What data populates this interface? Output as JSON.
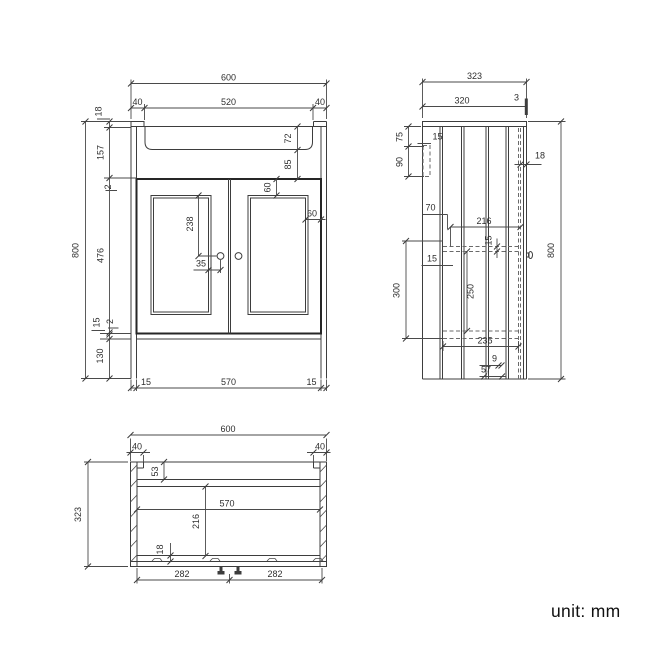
{
  "front": {
    "overall_width": "600",
    "basin_width": "520",
    "basin_offset_left": "40",
    "basin_offset_right": "40",
    "overall_height": "800",
    "top_thickness": "18",
    "upper_section": "157",
    "door_top_gap": "2",
    "door_height": "476",
    "door_bottom_gap": "2",
    "bottom_rail": "15",
    "plinth_height": "130",
    "basin_depth": "72",
    "basin_to_doors": "85",
    "panel_to_knob": "238",
    "knob_offset": "35",
    "panel_top_inset": "60",
    "panel_side_inset": "60",
    "side_thickness_left": "15",
    "interior_width": "570",
    "side_thickness_right": "15"
  },
  "side": {
    "overall_depth": "323",
    "top_depth": "320",
    "back_panel": "3",
    "rail_top_offset": "75",
    "rail_height": "90",
    "rail_thickness": "15",
    "back_gap": "70",
    "door_thickness": "18",
    "shelf_depth": "216",
    "shelf_thickness": "15",
    "shelf_back_gap": "15",
    "opening_height": "300",
    "shelf_to_bottom": "250",
    "bottom_panel_depth": "235",
    "plinth_recess": "9",
    "plinth_depth": "57",
    "overall_height": "800"
  },
  "plan": {
    "overall_width": "600",
    "bracket_left": "40",
    "bracket_right": "40",
    "overall_depth": "323",
    "back_rail_depth": "53",
    "interior_width": "570",
    "interior_depth": "216",
    "door_thickness": "18",
    "door_left_width": "282",
    "door_right_width": "282"
  },
  "footer": {
    "unit_label": "unit: mm"
  }
}
